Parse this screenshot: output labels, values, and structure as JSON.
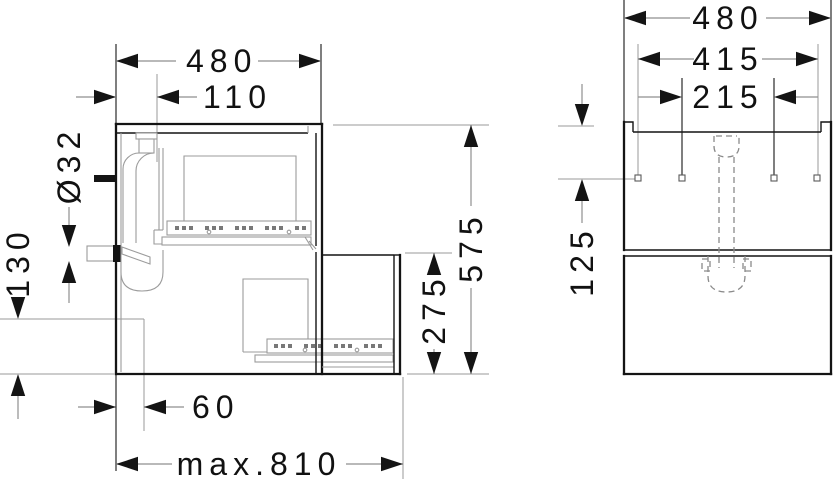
{
  "document": {
    "type": "installation-dimension-drawing",
    "background_color": "#ffffff",
    "line_color": "#141414",
    "secondary_line_color": "#9b9b9b"
  },
  "left_view": {
    "name": "side section view of vanity cabinet with drawers and drain trap",
    "dimensions": {
      "width": "480",
      "drain_offset": "110",
      "drain_diameter": "Ø32",
      "outlet_height": "130",
      "height": "575",
      "drawer_front_height": "275",
      "front_clearance": "60",
      "max_extension": "max.810"
    }
  },
  "right_view": {
    "name": "front view with wall mounting points and siphon",
    "dimensions": {
      "width": "480",
      "mounting_span_outer": "415",
      "mounting_span_inner": "215",
      "top_to_mounting": "125"
    }
  }
}
